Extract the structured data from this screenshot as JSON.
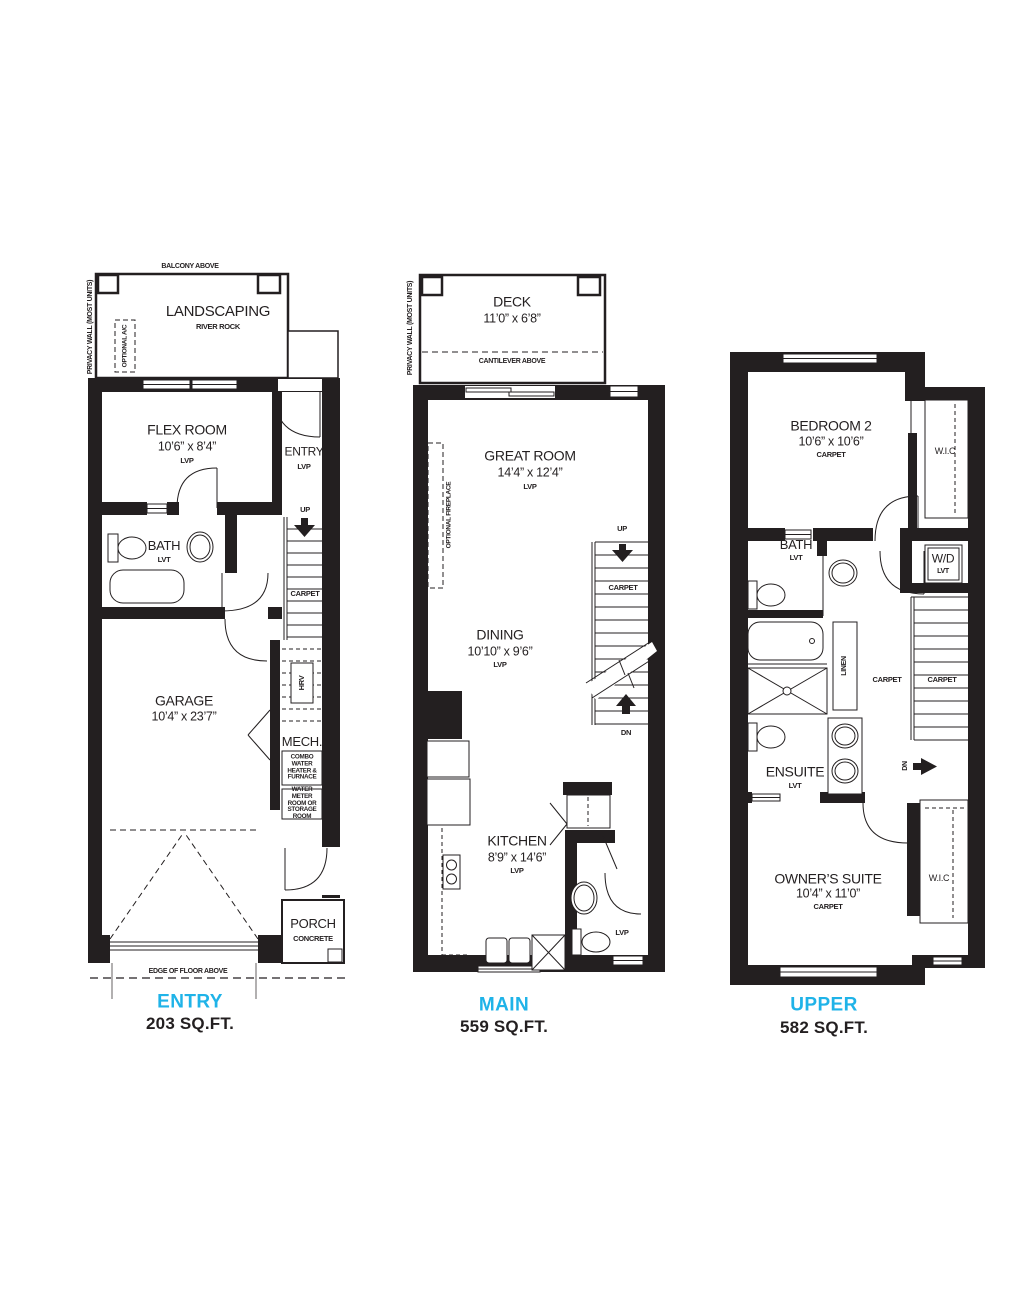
{
  "sheet": {
    "background": "#ffffff",
    "accent_color": "#1fb3e8",
    "line_color": "#231f20"
  },
  "common": {
    "up": "UP",
    "dn": "DN",
    "carpet": "CARPET",
    "lvp": "LVP",
    "lvt": "LVT",
    "wic": "W.I.C",
    "privacy_wall": "PRIVACY WALL (MOST UNITS)"
  },
  "entry_plan": {
    "title": "ENTRY",
    "sqft": "203 SQ.FT.",
    "balcony_note": "BALCONY ABOVE",
    "landscaping": {
      "name": "LANDSCAPING",
      "finish": "RIVER ROCK"
    },
    "optional_ac": "OPTIONAL A/C",
    "flex_room": {
      "name": "FLEX ROOM",
      "dims": "10’6” x 8’4”"
    },
    "entry_hall": {
      "name": "ENTRY"
    },
    "bath": {
      "name": "BATH"
    },
    "garage": {
      "name": "GARAGE",
      "dims": "10’4” x 23’7”"
    },
    "hrv": "HRV",
    "mech": {
      "name": "MECH.",
      "combo": "COMBO WATER HEATER & FURNACE",
      "water": "WATER METER ROOM OR STORAGE ROOM"
    },
    "porch": {
      "name": "PORCH",
      "finish": "CONCRETE"
    },
    "edge_note": "EDGE OF FLOOR ABOVE"
  },
  "main_plan": {
    "title": "MAIN",
    "sqft": "559 SQ.FT.",
    "deck": {
      "name": "DECK",
      "dims": "11’0” x 6’8”"
    },
    "cantilever_note": "CANTILEVER ABOVE",
    "optional_fireplace": "OPTIONAL FIREPLACE",
    "great_room": {
      "name": "GREAT ROOM",
      "dims": "14’4” x 12’4”"
    },
    "dining": {
      "name": "DINING",
      "dims": "10’10” x 9’6”"
    },
    "kitchen": {
      "name": "KITCHEN",
      "dims": "8’9” x 14’6”"
    }
  },
  "upper_plan": {
    "title": "UPPER",
    "sqft": "582 SQ.FT.",
    "bedroom2": {
      "name": "BEDROOM 2",
      "dims": "10’6” x 10’6”"
    },
    "bath": {
      "name": "BATH"
    },
    "wd": {
      "name": "W/D"
    },
    "linen": "LINEN",
    "ensuite": {
      "name": "ENSUITE"
    },
    "owners_suite": {
      "name": "OWNER’S SUITE",
      "dims": "10’4” x 11’0”"
    }
  }
}
